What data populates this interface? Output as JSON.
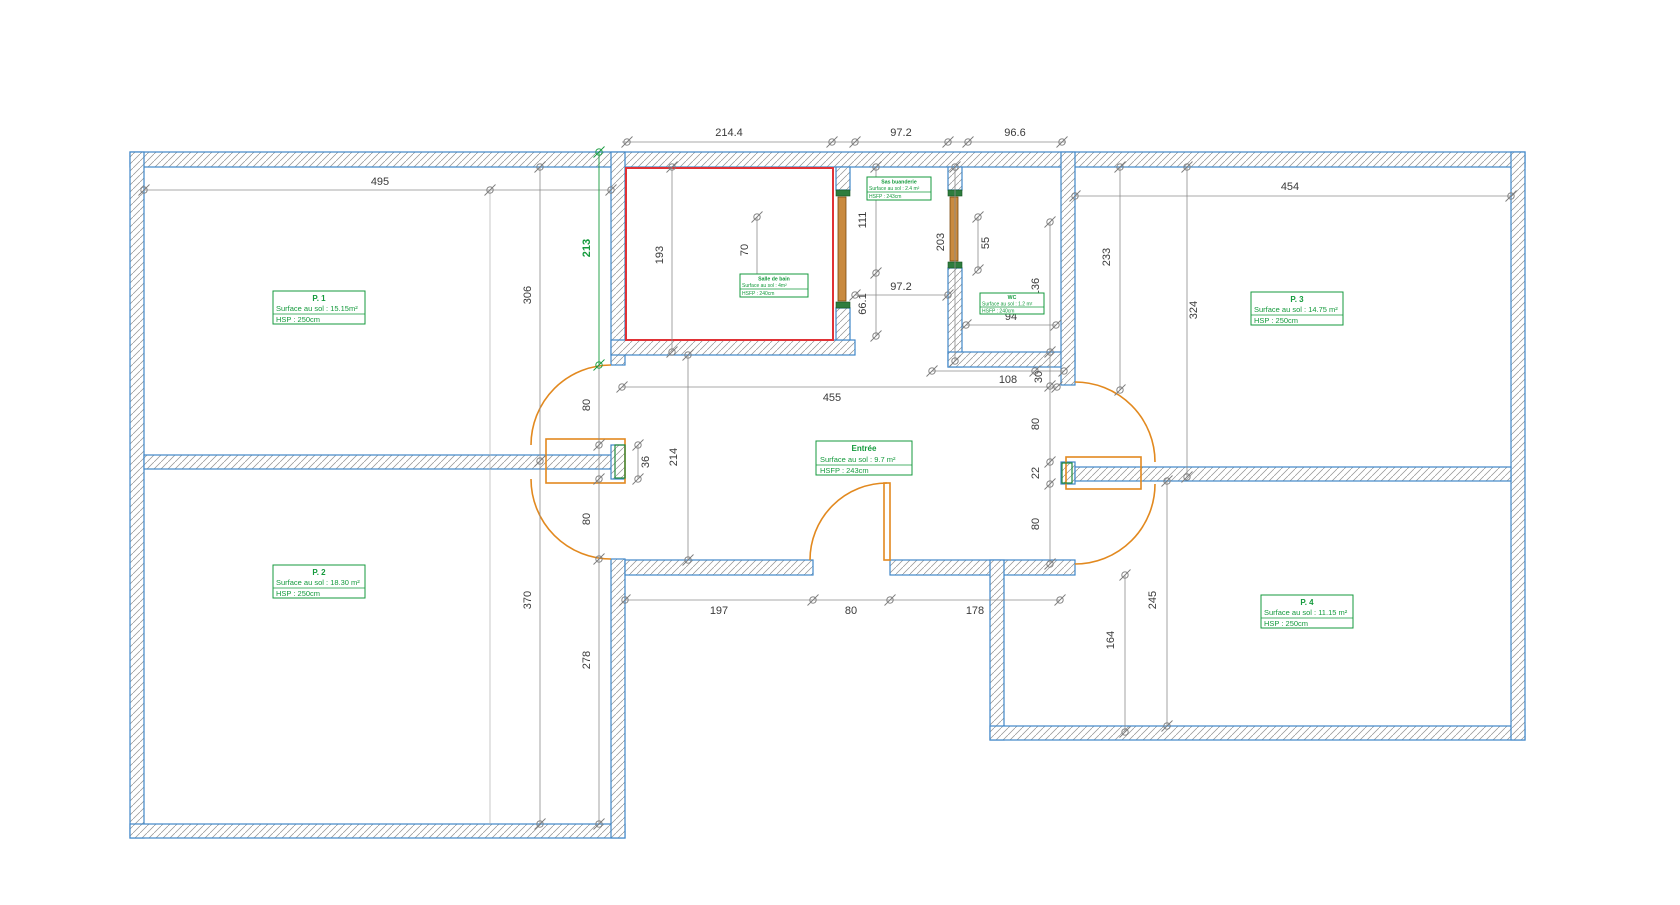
{
  "drawing_type": "architectural-floor-plan",
  "colors": {
    "wall_outline": "#3f87c9",
    "hatch": "#909090",
    "dimension": "#8c8c8c",
    "room_label_green": "#149a3c",
    "bathroom_highlight_red": "#e03236",
    "door_orange": "#e2891f"
  },
  "rooms": [
    {
      "name": "P. 1",
      "surface": "Surface au sol  : 15.15m²",
      "height": "HSP : 250cm"
    },
    {
      "name": "P. 2",
      "surface": "Surface au sol  : 18.30 m²",
      "height": "HSP : 250cm"
    },
    {
      "name": "P. 3",
      "surface": "Surface au sol  : 14.75 m²",
      "height": "HSP : 250cm"
    },
    {
      "name": "P. 4",
      "surface": "Surface au sol  : 11.15 m²",
      "height": "HSP : 250cm"
    },
    {
      "name": "Entrée",
      "surface": "Surface au sol  : 9.7 m²",
      "height": "HSFP :  243cm"
    },
    {
      "name": "Salle de bain",
      "surface": "Surface au sol  : 4m²",
      "height": "HSFP : 240cm"
    },
    {
      "name": "Sas buanderie",
      "surface": "Surface au sol  : 2.4 m²",
      "height": "HSFP : 243cm"
    },
    {
      "name": "WC",
      "surface": "Surface au sol  : 1.2 m²",
      "height": "HSFP : 240cm"
    }
  ],
  "dims": [
    "214.4",
    "97.2",
    "96.6",
    "495",
    "454",
    "306",
    "370",
    "213",
    "278",
    "80",
    "80",
    "36",
    "214",
    "193",
    "70",
    "111",
    "66.1",
    "203",
    "55",
    "136",
    "97.2",
    "94",
    "108",
    "30",
    "455",
    "80",
    "22",
    "80",
    "233",
    "324",
    "245",
    "164",
    "197",
    "80",
    "178"
  ]
}
